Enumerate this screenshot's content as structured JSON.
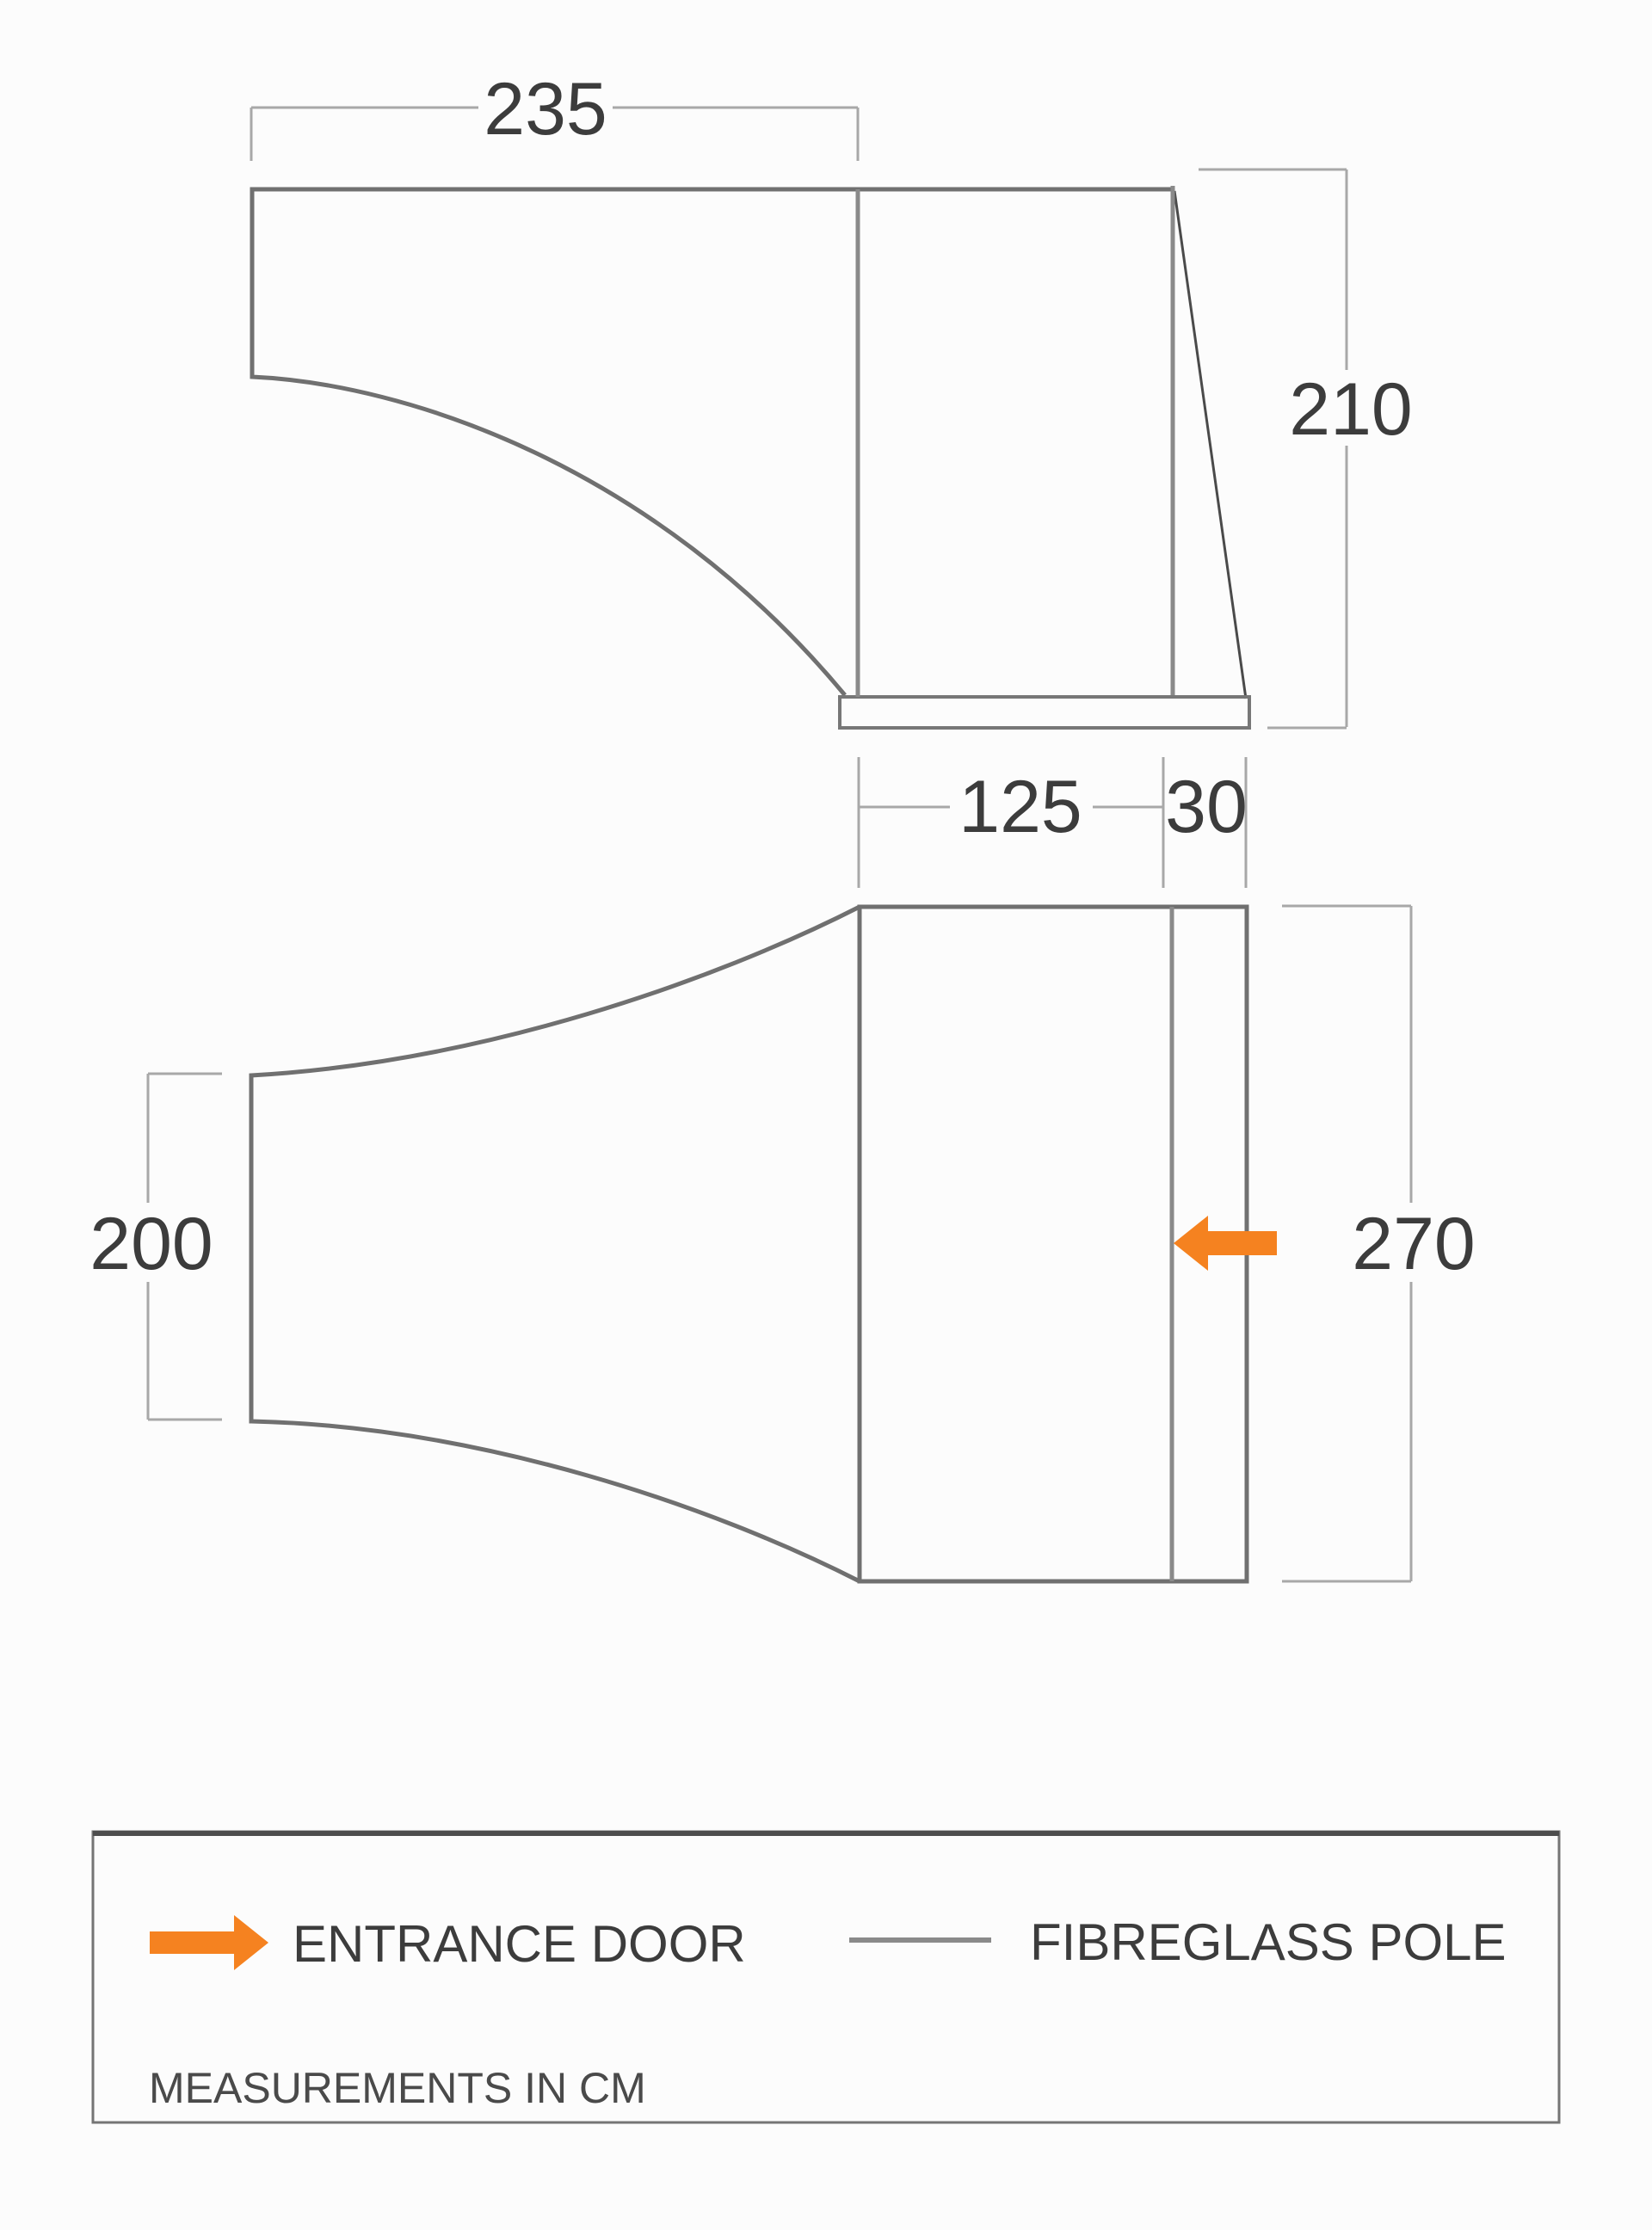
{
  "colors": {
    "background": "#fcfcfc",
    "outline_gray": "#707070",
    "pole_gray": "#8a8a8a",
    "front_edge_dark": "#4a4a4a",
    "dimension_gray": "#a8a8a8",
    "text_dark": "#3c3c3c",
    "entrance_orange": "#F58220"
  },
  "side_view": {
    "top_width_cm": "235",
    "height_cm": "210"
  },
  "front_dimensions": {
    "panel_width_cm": "125",
    "door_strip_cm": "30"
  },
  "plan_view": {
    "rear_width_cm": "200",
    "depth_cm": "270"
  },
  "legend": {
    "entrance_door_label": "ENTRANCE DOOR",
    "fibreglass_pole_label": "FIBREGLASS POLE",
    "note": "MEASUREMENTS IN CM"
  }
}
